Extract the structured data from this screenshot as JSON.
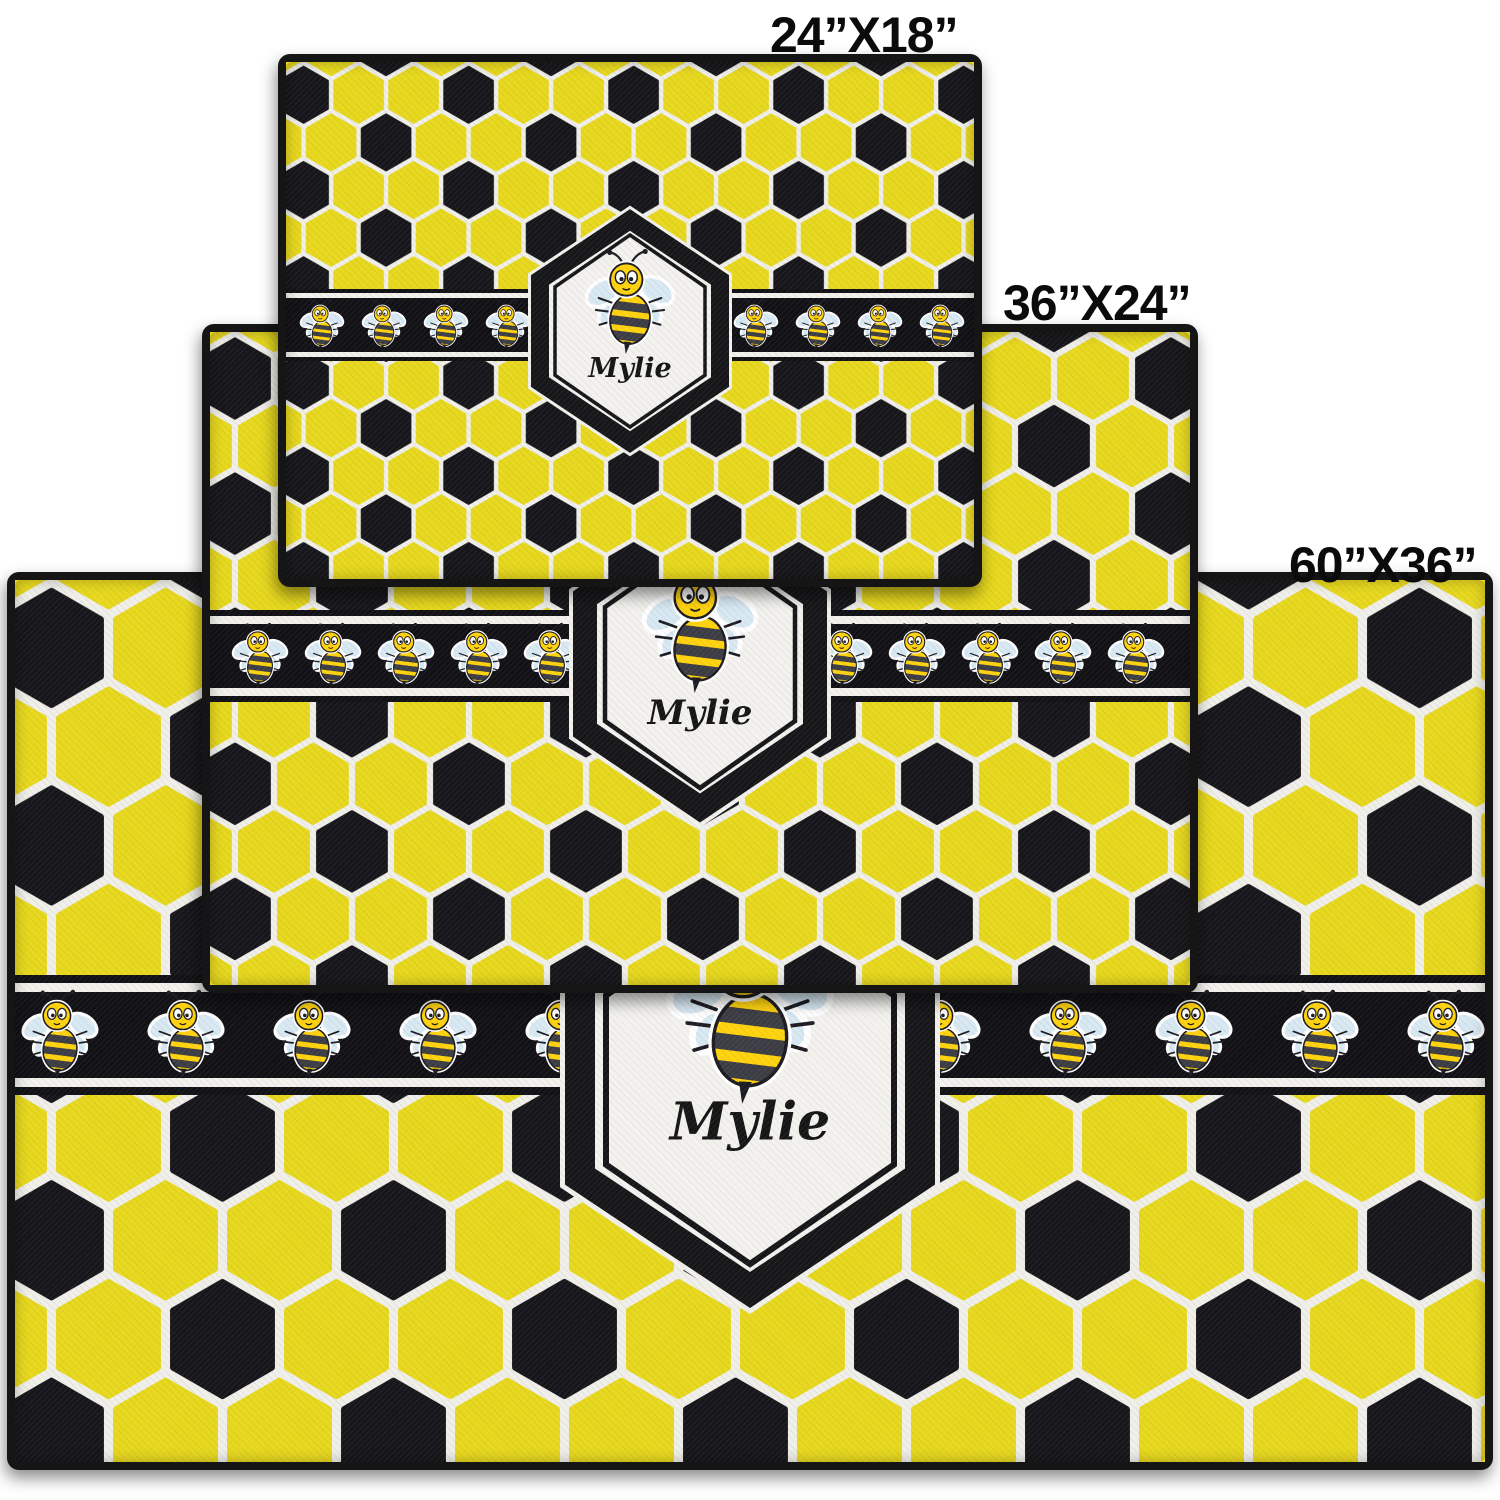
{
  "page": {
    "background": "#FFFFFF"
  },
  "product": {
    "personalization_name": "Mylie",
    "sizes": [
      {
        "id": "24x18",
        "label": "24”X18”"
      },
      {
        "id": "36x24",
        "label": "36”X24”"
      },
      {
        "id": "60x36",
        "label": "60”X36”"
      }
    ]
  },
  "icons": {
    "bee": "bee-icon"
  },
  "colors": {
    "hex_yellow": "#E7D81D",
    "hex_black": "#17171B",
    "grout_white": "#F0EFE9",
    "band_black": "#121216",
    "band_line_white": "#F2F1EC",
    "bee_yellow": "#FFD30E",
    "bee_stripe": "#3D3D45",
    "bee_outline": "#1C1C22",
    "wing_blue": "#D8E9F3",
    "badge_fill": "#F3F2EE",
    "badge_border": "#17171A",
    "label_text": "#0B0B0B"
  }
}
